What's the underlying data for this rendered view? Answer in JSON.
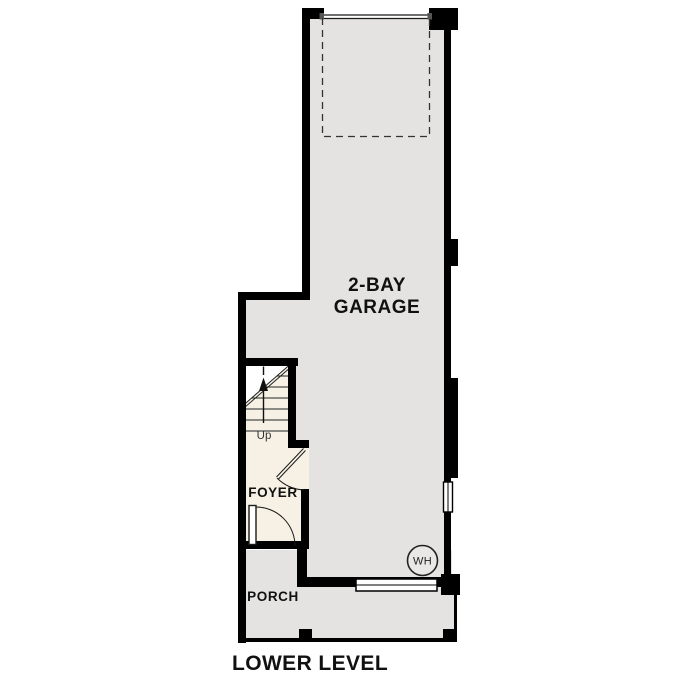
{
  "plan": {
    "title": "LOWER LEVEL",
    "rooms": {
      "garage": {
        "label_line1": "2-BAY",
        "label_line2": "GARAGE"
      },
      "foyer": {
        "label": "FOYER"
      },
      "porch": {
        "label": "PORCH"
      }
    },
    "stairs": {
      "direction_label": "Up"
    },
    "water_heater": {
      "label": "WH"
    }
  },
  "colors": {
    "wall": "#000000",
    "floor": "#e4e3e1",
    "foyer_floor": "#f7f1e5",
    "wh_fill": "#e9e8e6",
    "line": "#1a1a1a"
  }
}
